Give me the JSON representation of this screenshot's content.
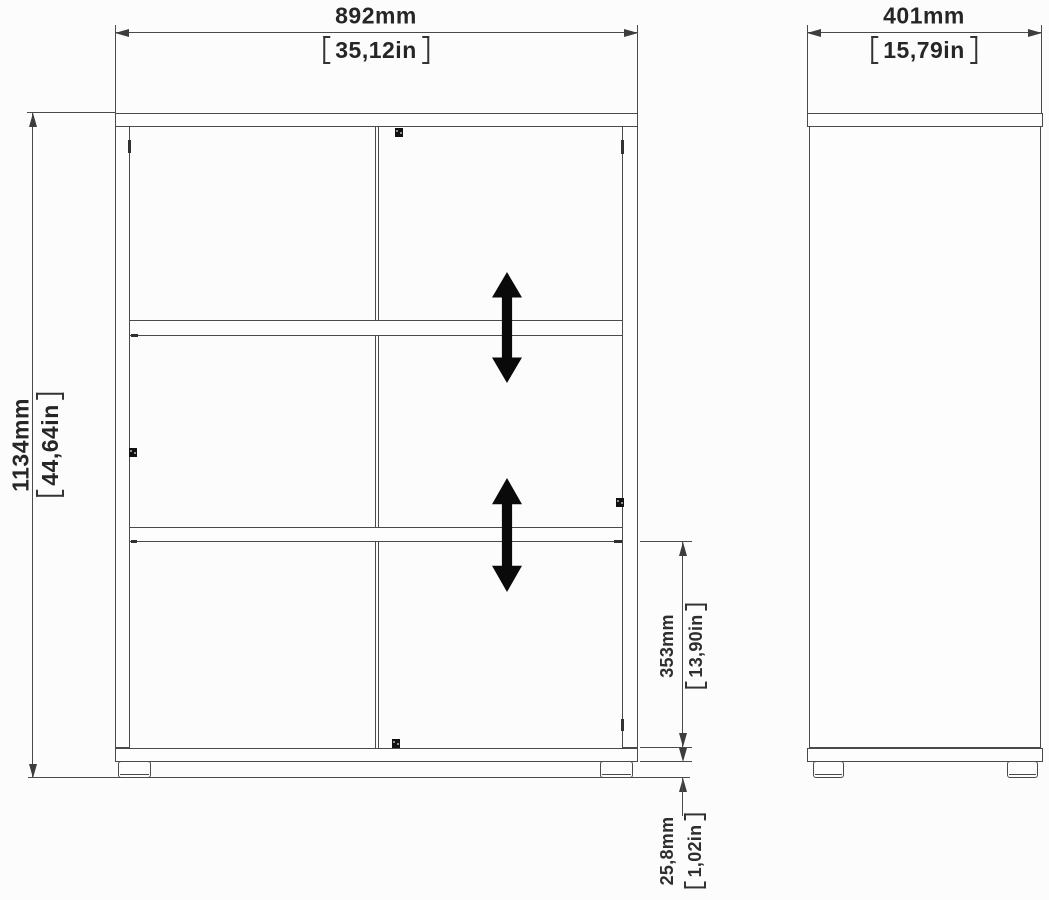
{
  "drawing": {
    "front": {
      "width_mm": "892mm",
      "width_in": "35,12in",
      "height_mm": "1134mm",
      "height_in": "44,64in",
      "shelf_mm": "353mm",
      "shelf_in": "13,90in",
      "feet_mm": "25,8mm",
      "feet_in": "1,02in"
    },
    "side": {
      "depth_mm": "401mm",
      "depth_in": "15,79in"
    },
    "icons": {
      "adjustable_shelf_arrow": "double-headed-vertical-arrow",
      "cam_lock": "black-square-cam-dot"
    },
    "colors": {
      "line": "#4a4a4a",
      "text": "#262626",
      "arrow": "#0a0a0a",
      "background": "#fcfcfc"
    }
  }
}
